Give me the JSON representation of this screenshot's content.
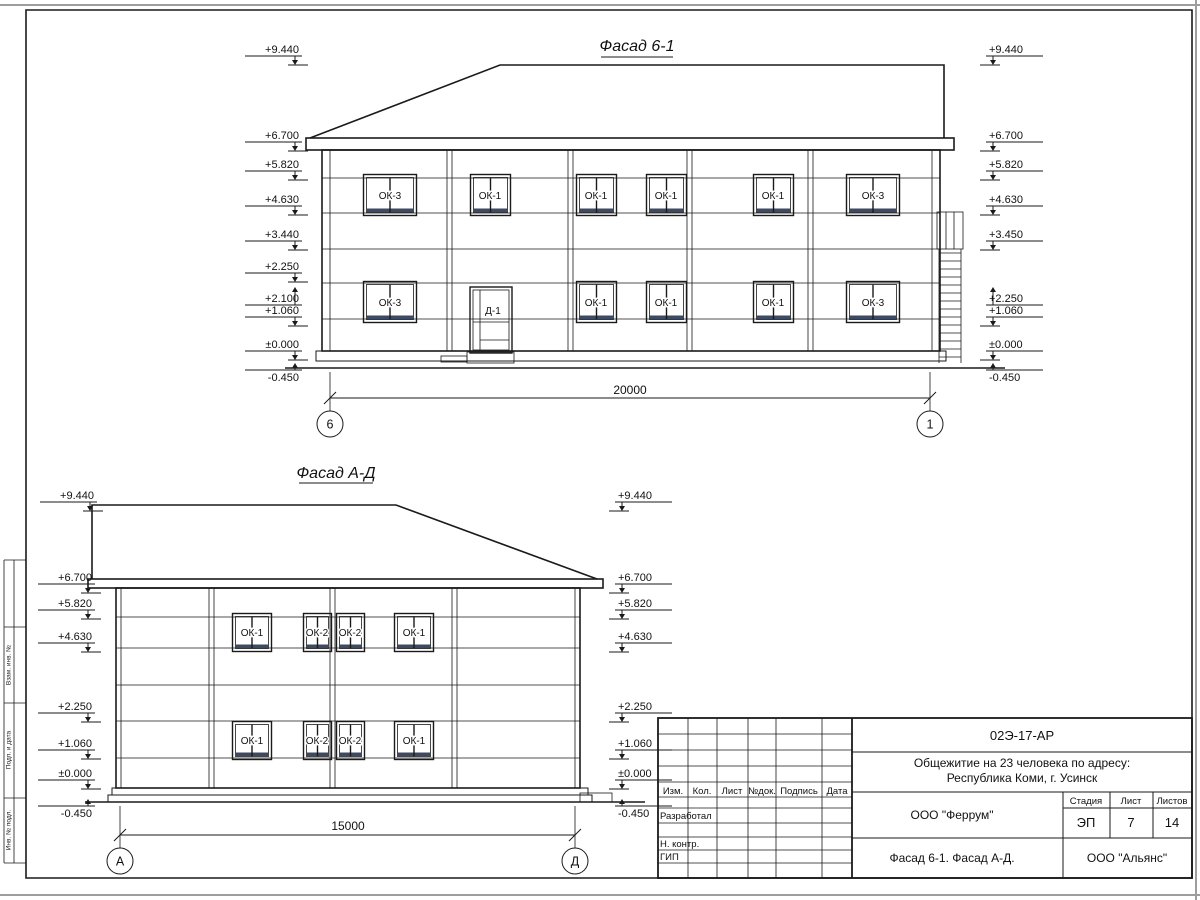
{
  "sheet": {
    "side_labels": [
      "Взам. инв. №",
      "Подп. и дата",
      "Инв. № подл."
    ]
  },
  "facade1": {
    "title": "Фасад 6-1",
    "levels_left": [
      "+9.440",
      "+6.700",
      "+5.820",
      "+4.630",
      "+3.440",
      "+2.250",
      "+2.100",
      "+1.060",
      "±0.000",
      "-0.450"
    ],
    "levels_right": [
      "+9.440",
      "+6.700",
      "+5.820",
      "+4.630",
      "+3.450",
      "+2.250",
      "+1.060",
      "±0.000",
      "-0.450"
    ],
    "windows_upper": [
      "ОК-3",
      "ОК-1",
      "ОК-1",
      "ОК-1",
      "ОК-1",
      "ОК-3"
    ],
    "windows_lower": [
      "ОК-3",
      "ОК-1",
      "ОК-1",
      "ОК-1",
      "ОК-3"
    ],
    "door_label": "Д-1",
    "dimension": "20000",
    "axis_left": "6",
    "axis_right": "1"
  },
  "facade2": {
    "title": "Фасад А-Д",
    "levels": [
      "+9.440",
      "+6.700",
      "+5.820",
      "+4.630",
      "+2.250",
      "+1.060",
      "±0.000",
      "-0.450"
    ],
    "windows_upper": [
      "ОК-1",
      "ОК-2",
      "ОК-2",
      "ОК-1"
    ],
    "windows_lower": [
      "ОК-1",
      "ОК-2",
      "ОК-2",
      "ОК-1"
    ],
    "dimension": "15000",
    "axis_left": "А",
    "axis_right": "Д"
  },
  "titleblock": {
    "doc_number": "02Э-17-АР",
    "project_line1": "Общежитие на 23 человека по адресу:",
    "project_line2": "Республика Коми, г. Усинск",
    "rev_columns": [
      "Изм.",
      "Кол.",
      "Лист",
      "№док.",
      "Подпись",
      "Дата"
    ],
    "row_developed": "Разработал",
    "row_ncontrol": "Н. контр.",
    "row_gip": "ГИП",
    "org": "ООО \"Феррум\"",
    "stage_label": "Стадия",
    "sheet_label": "Лист",
    "sheets_label": "Листов",
    "stage": "ЭП",
    "sheet": "7",
    "sheets": "14",
    "drawing_title": "Фасад 6-1. Фасад  А-Д.",
    "org2": "ООО \"Альянс\""
  }
}
